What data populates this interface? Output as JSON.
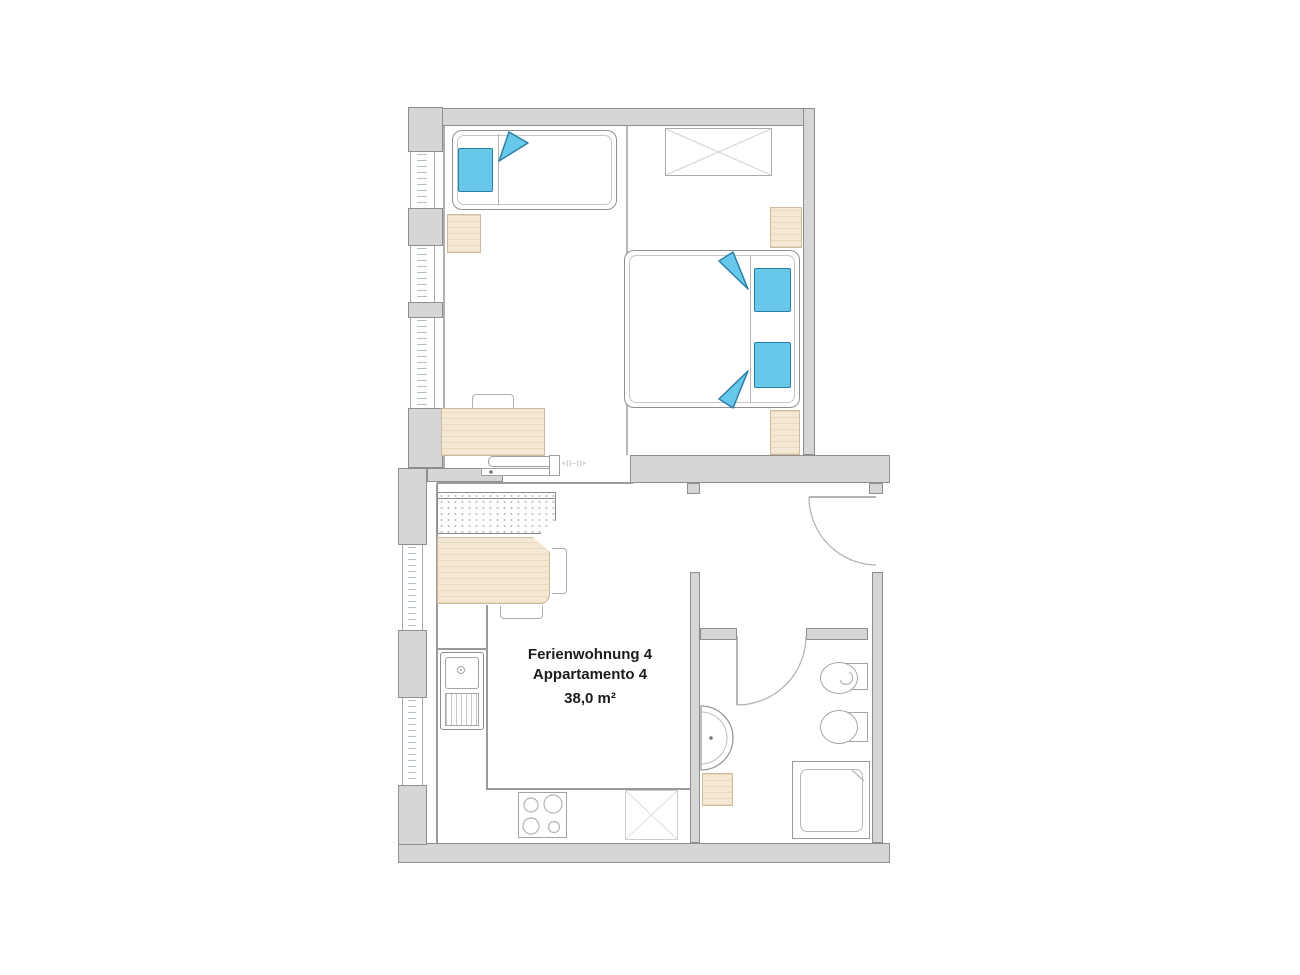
{
  "plan": {
    "title_line1": "Ferienwohnung 4",
    "title_line2": "Appartamento 4",
    "area": "38,0 m²",
    "dim_note": "«()–()»"
  },
  "colors": {
    "wall_fill": "#d6d6d6",
    "wall_edge": "#8e8e8e",
    "accent_blue": "#67c8ea",
    "accent_blue_edge": "#2b7fa6",
    "beige": "#f4e7d3",
    "beige_edge": "#cdbb9b",
    "text": "#1c1c1c"
  }
}
